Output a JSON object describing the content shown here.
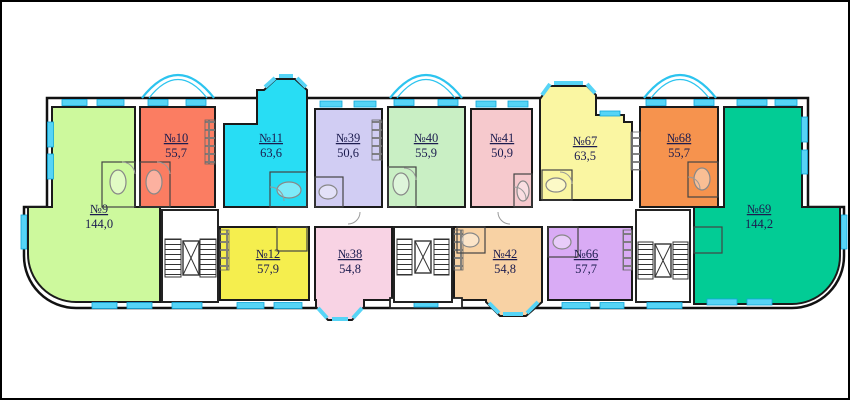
{
  "plan": {
    "title": "apartment-building-floor-plan",
    "background_color": "#ffffff",
    "wall_color": "#1a1a1a",
    "window_color": "#56d4f6",
    "window_border_color": "#0fa6da",
    "arc_glazing_color": "#2cc4ef",
    "label_color": "#1c1c4f"
  },
  "apartments": [
    {
      "id": "9",
      "number": "№9",
      "area": "144,0",
      "color": "#cdf99d"
    },
    {
      "id": "10",
      "number": "№10",
      "area": "55,7",
      "color": "#fb7d62"
    },
    {
      "id": "11",
      "number": "№11",
      "area": "63,6",
      "color": "#28ddf4"
    },
    {
      "id": "39",
      "number": "№39",
      "area": "50,6",
      "color": "#d1cdf3"
    },
    {
      "id": "40",
      "number": "№40",
      "area": "55,9",
      "color": "#c9efc4"
    },
    {
      "id": "41",
      "number": "№41",
      "area": "50,9",
      "color": "#f6c9cd"
    },
    {
      "id": "67",
      "number": "№67",
      "area": "63,5",
      "color": "#faf6a2"
    },
    {
      "id": "68",
      "number": "№68",
      "area": "55,7",
      "color": "#f6934e"
    },
    {
      "id": "69",
      "number": "№69",
      "area": "144,2",
      "color": "#02cc95"
    },
    {
      "id": "12",
      "number": "№12",
      "area": "57,9",
      "color": "#f5ee4e"
    },
    {
      "id": "38",
      "number": "№38",
      "area": "54,8",
      "color": "#f8d3e4"
    },
    {
      "id": "42",
      "number": "№42",
      "area": "54,8",
      "color": "#f8d2a4"
    },
    {
      "id": "66",
      "number": "№66",
      "area": "57,7",
      "color": "#d9abf5"
    }
  ],
  "cores": {
    "stairwell_count": "3",
    "elevator_count": "3"
  }
}
